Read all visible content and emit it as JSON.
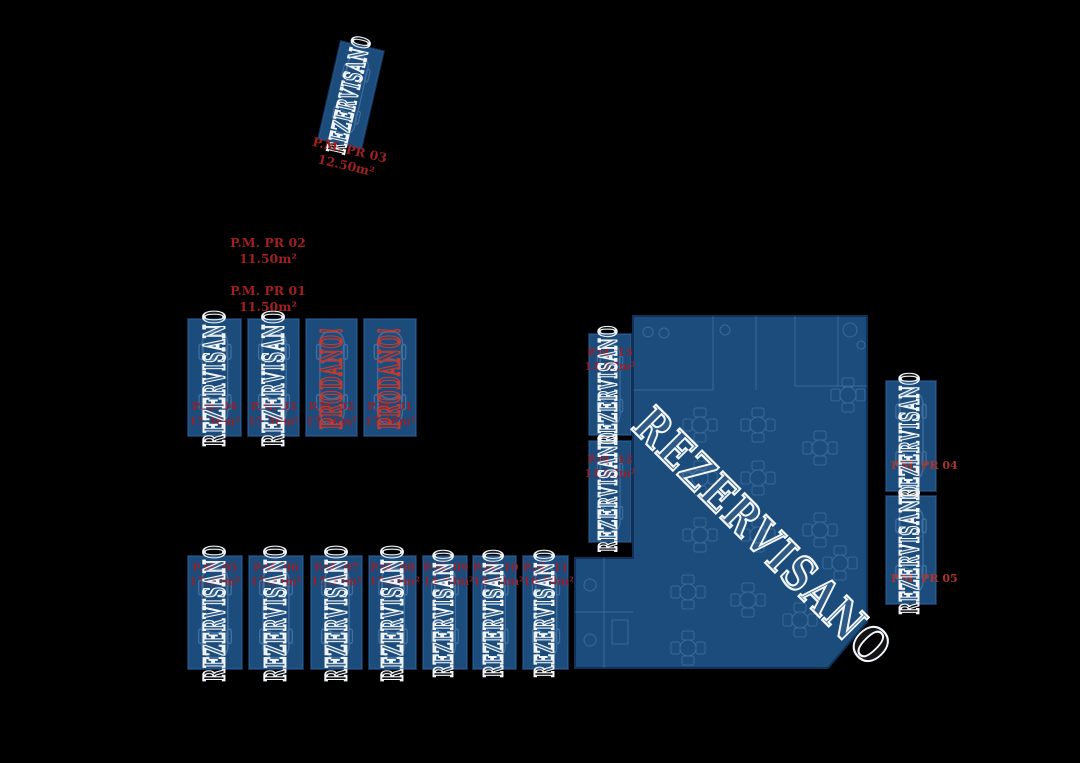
{
  "plan": {
    "background": "#000000",
    "unit_fill": "#1c4c7c",
    "reserved_outline": "#f2f6fa",
    "sold_outline": "#c23b30",
    "label_red": "#8f2330"
  },
  "spots": [
    {
      "name": "P.M. PR 03",
      "area": "12.50m²",
      "status": "REZERVISANO"
    },
    {
      "name": "P.M. 04",
      "area": "17.36m²",
      "status": "REZERVISANO"
    },
    {
      "name": "P.M. 03",
      "area": "17.36m²",
      "status": "REZERVISANO"
    },
    {
      "name": "P.M. 02",
      "area": "17.36m²",
      "status": "PRODANO!"
    },
    {
      "name": "P.M. 01",
      "area": "17.48m²",
      "status": "PRODANO!"
    },
    {
      "name": "P.M. 05",
      "area": "17.36m²",
      "status": "REZERVISANO"
    },
    {
      "name": "P.M. 06",
      "area": "17.36m²",
      "status": "REZERVISANO"
    },
    {
      "name": "P.M. 07",
      "area": "17.36m²",
      "status": "REZERVISANO"
    },
    {
      "name": "P.M. 08",
      "area": "17.36m²",
      "status": "REZERVISANO"
    },
    {
      "name": "P.M. 09",
      "area": "14.40m²",
      "status": "REZERVISANO"
    },
    {
      "name": "P.M. 10",
      "area": "14.40m²",
      "status": "REZERVISANO"
    },
    {
      "name": "P.M. 11",
      "area": "16.50m²",
      "status": "REZERVISANO"
    },
    {
      "name": "P.M. 13",
      "area": "11.62m²",
      "status": "REZERVISANO"
    },
    {
      "name": "P.M. 12",
      "area": "11.62m²",
      "status": "REZERVISANO"
    },
    {
      "name": "P.M. PR 04",
      "area": "",
      "status": "REZERVISANO"
    },
    {
      "name": "P.M. PR 05",
      "area": "",
      "status": "REZERVISANO"
    }
  ],
  "free_labels": [
    {
      "name": "P.M. PR 02",
      "area": "11.50m²"
    },
    {
      "name": "P.M. PR 01",
      "area": "11.50m²"
    }
  ],
  "main_area": {
    "status": "REZERVISANO"
  }
}
